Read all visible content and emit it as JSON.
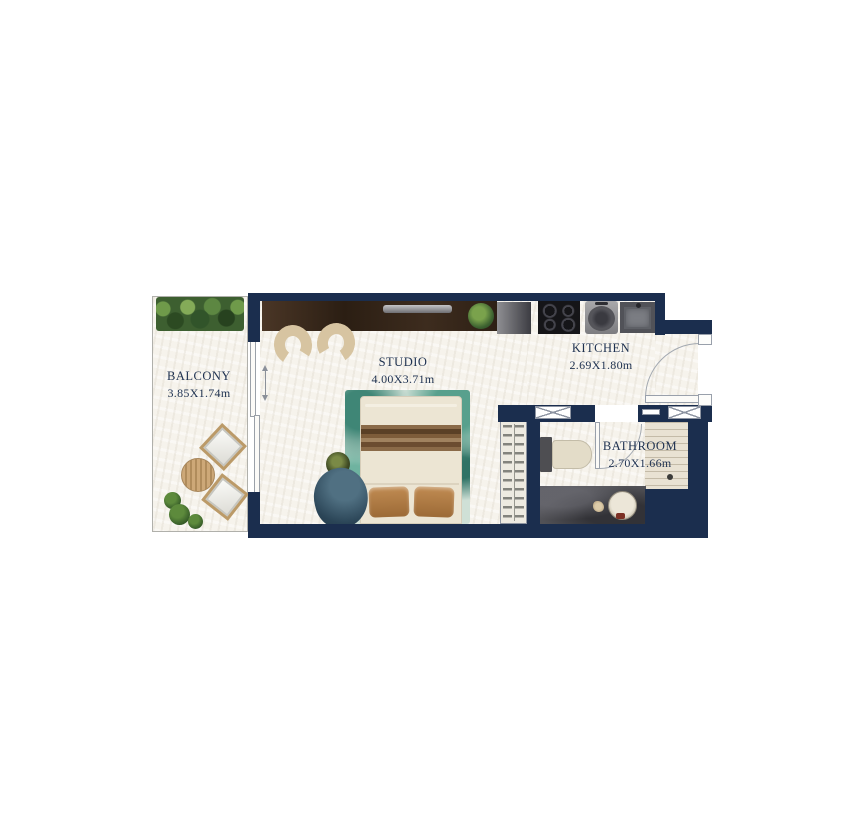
{
  "floor_plan": {
    "type": "studio-apartment-floor-plan",
    "rooms": [
      {
        "id": "balcony",
        "name": "BALCONY",
        "dimensions": "3.85X1.74m"
      },
      {
        "id": "studio",
        "name": "STUDIO",
        "dimensions": "4.00X3.71m"
      },
      {
        "id": "kitchen",
        "name": "KITCHEN",
        "dimensions": "2.69X1.80m"
      },
      {
        "id": "bathroom",
        "name": "BATHROOM",
        "dimensions": "2.70X1.66m"
      }
    ],
    "colors": {
      "wall": "#1b2e4e",
      "floor": "#f6f3ec",
      "label_text": "#1e3150",
      "balcony_border": "#b0b0ab",
      "rug_teal": "#58a08d",
      "cabinet_wood": "#3a2a1c",
      "bathroom_wet_floor": "#515156",
      "shower_tile": "#e9e2d3",
      "greenery": "#3d5f30"
    }
  }
}
